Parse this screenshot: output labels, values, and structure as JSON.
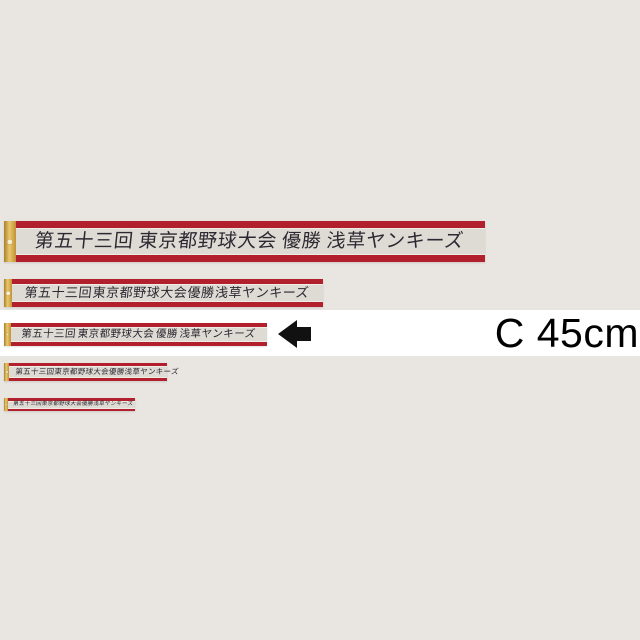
{
  "size_label": "C 45cm",
  "ribbon_count": 5,
  "ribbon_text": {
    "full": "第五十三回　東京都野球大会　優勝　浅草ヤンキーズ",
    "segments": [
      "第五十三回",
      "東京都野球大会",
      "優勝",
      "浅草ヤンキーズ"
    ]
  },
  "colors": {
    "background": "#e9e6e2",
    "highlight_band": "#ffffff",
    "ribbon_red": "#b1202c",
    "ribbon_field": "#dedbd5",
    "gold_edge": "#d4a94f",
    "arrow": "#111111",
    "label_text": "#000000"
  }
}
